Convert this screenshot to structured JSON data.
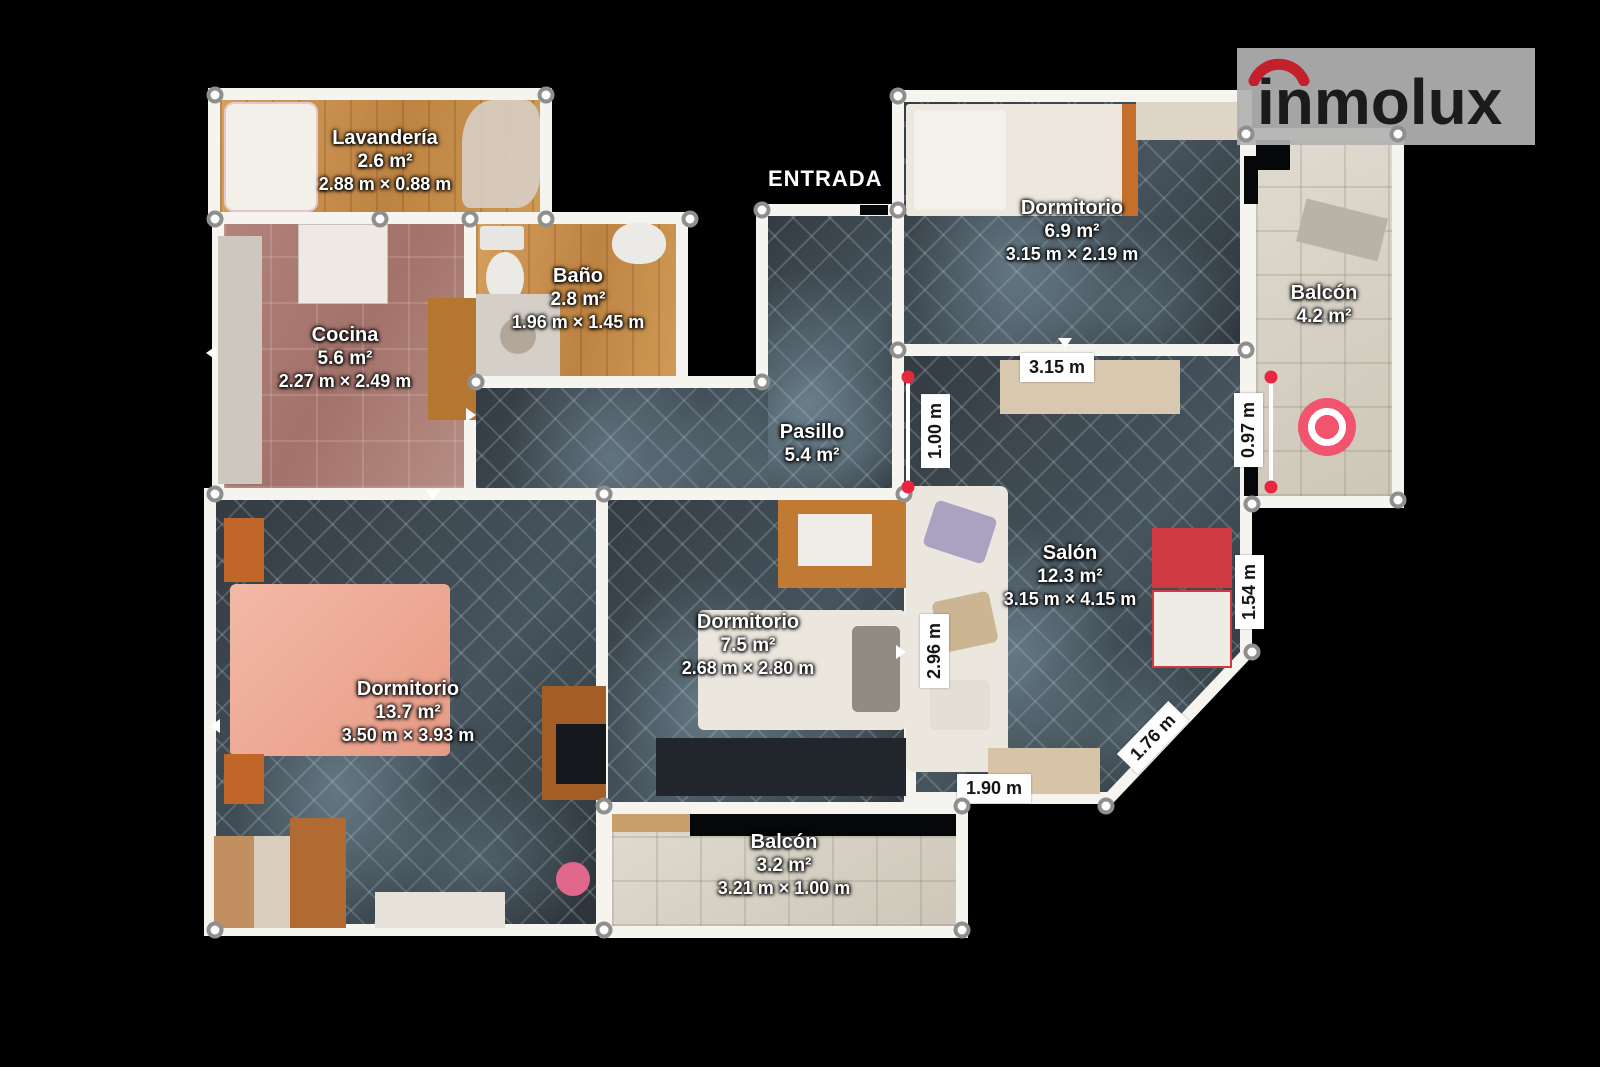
{
  "plan": {
    "entrance_label": "ENTRADA",
    "rooms": [
      {
        "name": "Lavandería",
        "area": "2.6 m²",
        "dims": "2.88 m × 0.88 m"
      },
      {
        "name": "Cocina",
        "area": "5.6 m²",
        "dims": "2.27 m × 2.49 m"
      },
      {
        "name": "Baño",
        "area": "2.8 m²",
        "dims": "1.96 m × 1.45 m"
      },
      {
        "name": "Pasillo",
        "area": "5.4 m²",
        "dims": ""
      },
      {
        "name": "Dormitorio",
        "area": "6.9 m²",
        "dims": "3.15 m × 2.19 m"
      },
      {
        "name": "Balcón",
        "area": "4.2 m²",
        "dims": ""
      },
      {
        "name": "Salón",
        "area": "12.3 m²",
        "dims": "3.15 m × 4.15 m"
      },
      {
        "name": "Dormitorio",
        "area": "13.7 m²",
        "dims": "3.50 m × 3.93 m"
      },
      {
        "name": "Dormitorio",
        "area": "7.5 m²",
        "dims": "2.68 m × 2.80 m"
      },
      {
        "name": "Balcón",
        "area": "3.2 m²",
        "dims": "3.21 m × 1.00 m"
      }
    ],
    "measurements": {
      "salon_top": "3.15 m",
      "pasillo_right": "1.00 m",
      "balcony_wall": "0.97 m",
      "salon_left": "2.96 m",
      "salon_right": "1.54 m",
      "salon_diagonal": "1.76 m",
      "salon_bottom": "1.90 m"
    }
  },
  "branding": {
    "logo_text": "inmolux",
    "logo_arc_color": "#c2202a",
    "logo_text_color": "#1b1b1b"
  },
  "colors": {
    "marker_pink": "#f2546d",
    "measure_dot_red": "#e8273f",
    "wall_white": "#f6f4ef",
    "background": "#000000"
  }
}
